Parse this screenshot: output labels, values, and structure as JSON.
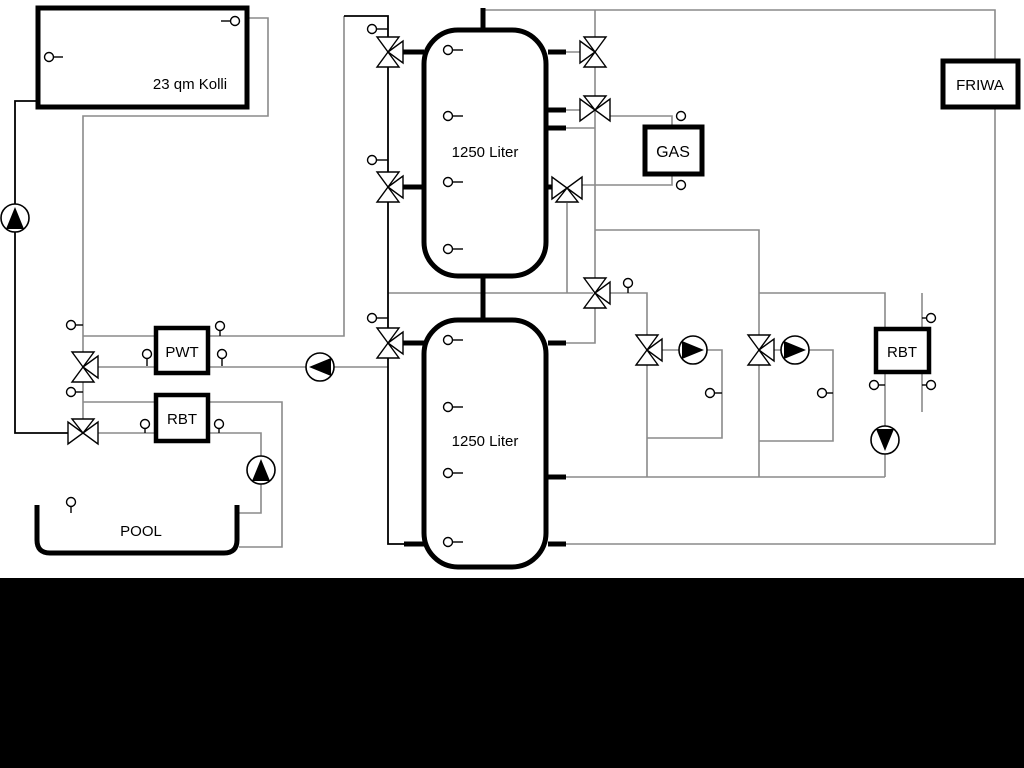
{
  "title": "Heating system hydraulic schematic",
  "labels": {
    "collector": "23 qm Kolli",
    "buffer_tank_top": "1250 Liter",
    "buffer_tank_bottom": "1250 Liter",
    "gas_boiler": "GAS",
    "fresh_water_module": "FRIWA",
    "plate_heat_exchanger": "PWT",
    "return_buffer_left": "RBT",
    "return_buffer_right": "RBT",
    "pool": "POOL"
  },
  "colors": {
    "background": "#ffffff",
    "bottom_band": "#000000",
    "outline": "#000000",
    "pipe_gray": "#8a8a8a",
    "pipe_black": "#000000",
    "pump_fill": "#000000",
    "symbol_fill": "#ffffff"
  },
  "legend": {
    "pump_icon": "circle with filled triangle (flow direction)",
    "three_way_valve_icon": "bowtie of hollow triangles",
    "temperature_sensor_icon": "small circle with stem"
  }
}
